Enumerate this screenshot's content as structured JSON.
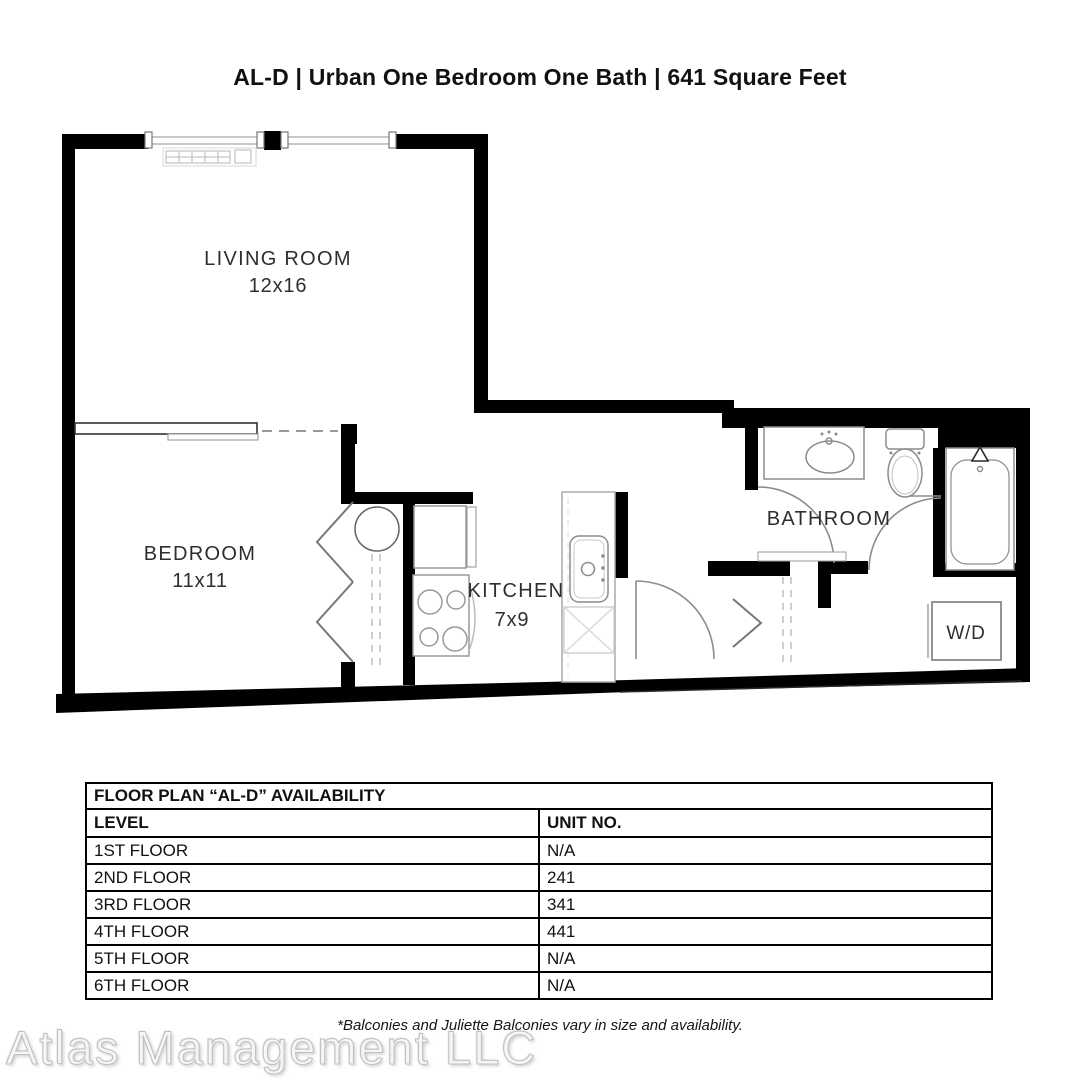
{
  "title": "AL-D | Urban One Bedroom One Bath | 641 Square Feet",
  "floor_plan": {
    "rooms": [
      {
        "name": "LIVING ROOM",
        "dims": "12x16"
      },
      {
        "name": "BEDROOM",
        "dims": "11x11"
      },
      {
        "name": "KITCHEN",
        "dims": "7x9"
      },
      {
        "name": "BATHROOM",
        "dims": ""
      }
    ],
    "wd_label": "W/D"
  },
  "availability_table": {
    "title": "FLOOR PLAN “AL-D” AVAILABILITY",
    "columns": [
      "LEVEL",
      "UNIT NO."
    ],
    "rows": [
      {
        "level": "1ST FLOOR",
        "unit": "N/A"
      },
      {
        "level": "2ND FLOOR",
        "unit": "241"
      },
      {
        "level": "3RD FLOOR",
        "unit": "341"
      },
      {
        "level": "4TH FLOOR",
        "unit": "441"
      },
      {
        "level": "5TH FLOOR",
        "unit": "N/A"
      },
      {
        "level": "6TH FLOOR",
        "unit": "N/A"
      }
    ]
  },
  "footnote": "*Balconies and Juliette Balconies vary in size and availability.",
  "watermark": "Atlas Management LLC",
  "colors": {
    "wall": "#000000",
    "fixture_stroke": "#8c8c8c",
    "label_text": "#2e2e2e"
  }
}
